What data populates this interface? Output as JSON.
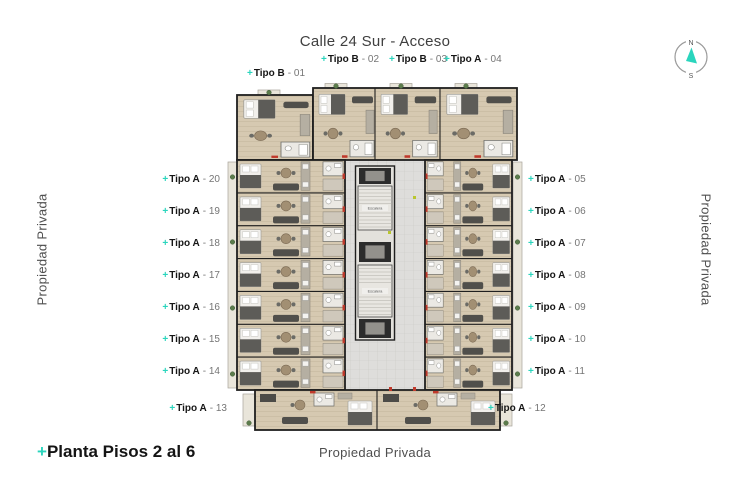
{
  "street_title": "Calle 24 Sur - Acceso",
  "boundaries": {
    "left": "Propiedad Privada",
    "right": "Propiedad Privada",
    "bottom": "Propiedad Privada"
  },
  "plan_title": "Planta Pisos 2 al 6",
  "plus": "+",
  "compass": {
    "north": "N",
    "south": "S"
  },
  "stairs": {
    "upper": "Escalera",
    "lower": "Escalera"
  },
  "units": {
    "top": [
      {
        "type": "Tipo B",
        "num": "- 01"
      },
      {
        "type": "Tipo B",
        "num": "- 02"
      },
      {
        "type": "Tipo B",
        "num": "- 03"
      },
      {
        "type": "Tipo A",
        "num": "- 04"
      }
    ],
    "left": [
      {
        "type": "Tipo A",
        "num": "- 20"
      },
      {
        "type": "Tipo A",
        "num": "- 19"
      },
      {
        "type": "Tipo A",
        "num": "- 18"
      },
      {
        "type": "Tipo A",
        "num": "- 17"
      },
      {
        "type": "Tipo A",
        "num": "- 16"
      },
      {
        "type": "Tipo A",
        "num": "- 15"
      },
      {
        "type": "Tipo A",
        "num": "- 14"
      }
    ],
    "right": [
      {
        "type": "Tipo A",
        "num": "- 05"
      },
      {
        "type": "Tipo A",
        "num": "- 06"
      },
      {
        "type": "Tipo A",
        "num": "- 07"
      },
      {
        "type": "Tipo A",
        "num": "- 08"
      },
      {
        "type": "Tipo A",
        "num": "- 09"
      },
      {
        "type": "Tipo A",
        "num": "- 10"
      },
      {
        "type": "Tipo A",
        "num": "- 11"
      }
    ],
    "bottom": [
      {
        "type": "Tipo A",
        "num": "- 13"
      },
      {
        "type": "Tipo A",
        "num": "- 12"
      }
    ]
  },
  "colors": {
    "accent": "#2ad5bd",
    "wall": "#1f1f1f",
    "floor": "#d6c9b1",
    "corridor": "#dedddb",
    "label_type": "#161616",
    "label_num": "#757575"
  }
}
